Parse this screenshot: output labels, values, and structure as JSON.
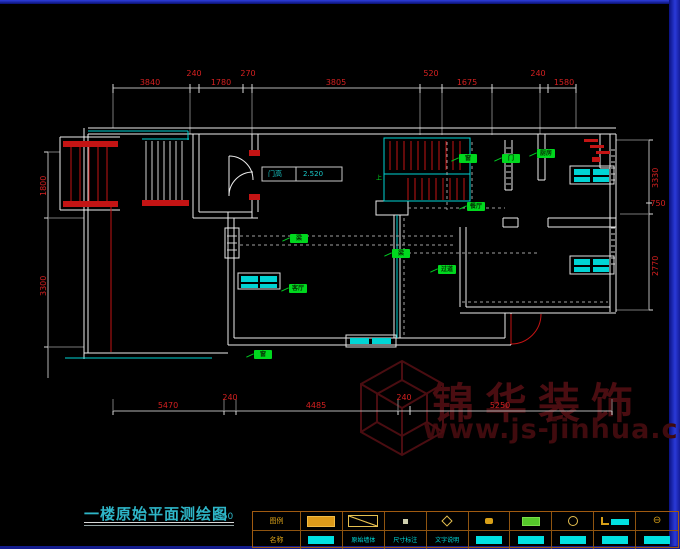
{
  "colors": {
    "wall": "#ececec",
    "stair_red": "#c41414",
    "accent_cyan": "#00d4d4",
    "label_green": "#00d81e",
    "dim_red": "#d42020",
    "watermark_red": "#4a0d11",
    "legend_orange": "#a05a10",
    "edge_blue": "#2a3ad8"
  },
  "title_block": {
    "title": "一楼原始平面测绘图",
    "scale": "1:60"
  },
  "watermark": {
    "brand": "锦华装饰",
    "url": "www.js-jinhua.com"
  },
  "door_tag": {
    "name": "门高",
    "value": "2.520"
  },
  "stair_note": "上",
  "plan_labels": [
    {
      "text": "窗"
    },
    {
      "text": "门"
    },
    {
      "text": "厨房"
    },
    {
      "text": "餐厅"
    },
    {
      "text": "梁"
    },
    {
      "text": "过道"
    },
    {
      "text": "梁"
    },
    {
      "text": "客厅"
    },
    {
      "text": "窗"
    }
  ],
  "dims": {
    "top": [
      "3840",
      "240",
      "1780",
      "270",
      "3805",
      "520",
      "1675",
      "240",
      "1580"
    ],
    "bottom": [
      "5470",
      "240",
      "4485",
      "240",
      "5250"
    ],
    "left": [
      "1800",
      "3300"
    ],
    "right": [
      "3330",
      "2770"
    ],
    "right_small": "750"
  },
  "legend": {
    "header_top": "图例",
    "header_bottom": "名称",
    "c3_label": "原始墙体",
    "c4_label": "尺寸标注",
    "c5_label": "文字说明"
  }
}
